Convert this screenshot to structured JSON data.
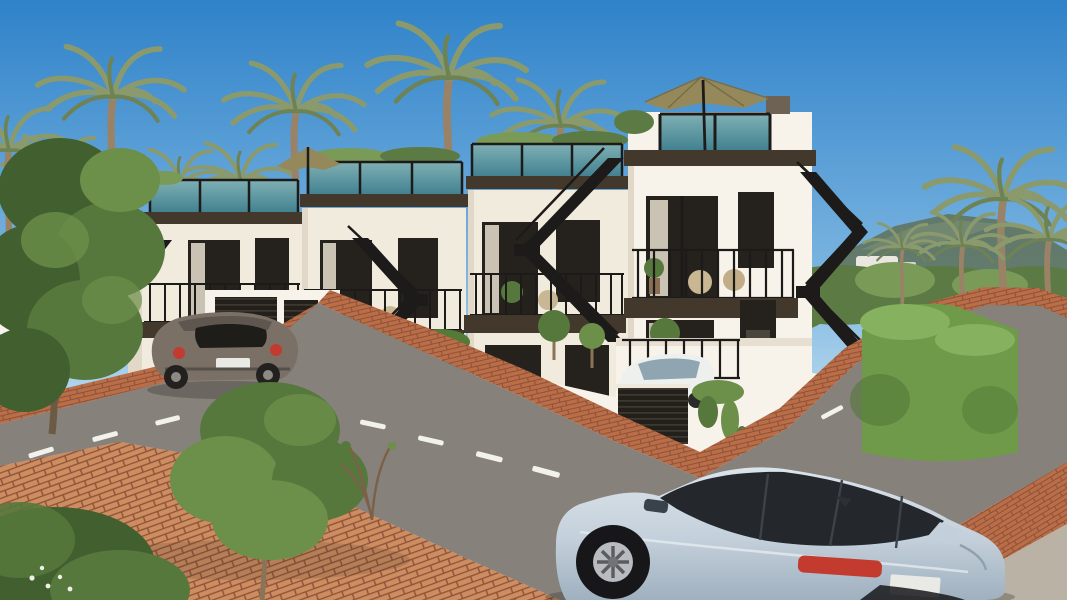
{
  "meta": {
    "title": "New-build terraced houses street view – architectural render",
    "type": "photorealistic exterior rendering",
    "width": 1067,
    "height": 600
  },
  "palette": {
    "sky_top": "#2f82c9",
    "sky_mid": "#7ab4e0",
    "sky_horizon": "#d9edf5",
    "hill": "#60745f",
    "hill_light": "#7d9077",
    "vegetation": "#5c7a43",
    "vegetation_light": "#7a9a58",
    "palm_frond": "#8a9a6c",
    "palm_frond_dark": "#6f8254",
    "palm_trunk": "#9a8266",
    "wall_sunlit": "#f1ebde",
    "wall_bright": "#f7f3ea",
    "wall_shaded": "#e2d8c7",
    "fascia": "#42382c",
    "roof_glass": "#3f7f8f",
    "roof_glass_light": "#7fb0b4",
    "metal": "#1c1b19",
    "window_dark": "#25221d",
    "curtain": "#ddd5c5",
    "slat_dark": "#23201c",
    "slat_line": "#3e382f",
    "road": "#9c968a",
    "road_light": "#aca698",
    "road_dark": "#86817a",
    "brick": "#b96e48",
    "brick_joint": "#8f5138",
    "brick_light": "#cc8d60",
    "marking": "#f2f1ec",
    "hedge": "#6f9a4a",
    "hedge_light": "#86b25f",
    "hedge_dark": "#547a38",
    "tree_dark": "#42602f",
    "tree_mid": "#57783c",
    "tree_light": "#6c8f4a",
    "umbrella": "#95895c",
    "umbrella_dark": "#776c45",
    "suv_body": "#c3cfda",
    "suv_body_dark": "#9fb0bf",
    "suv_glass": "#24272b",
    "beetle_body": "#7b7065",
    "beetle_dark": "#57504a",
    "white_car": "#eef0ee",
    "taillight": "#c33a2e",
    "plate": "#e9eae6",
    "concrete": "#b9b2a5",
    "shadow": "#2f2b25"
  },
  "scene": {
    "setting": "sunny coastal street with palm trees and hills",
    "buildings": {
      "count": 4,
      "style": "white modern townhouses stepping down a sloped street",
      "features": [
        "roof terraces with teal glass balustrades",
        "khaki parasols",
        "dark brown fascia bands",
        "black metal balconies",
        "external zig-zag staircases",
        "dark slatted garage doors",
        "terracotta brick walkways"
      ]
    },
    "vehicles": [
      {
        "type": "suv",
        "color": "light blue with black roof",
        "position": "driving in foreground"
      },
      {
        "type": "hatchback",
        "color": "grey-brown",
        "position": "parked at far kerb"
      },
      {
        "type": "crossover",
        "color": "white",
        "position": "driveway behind slatted gate"
      }
    ],
    "street": {
      "surface": "asphalt",
      "markings": "white dashed centre line",
      "sidewalk": "terracotta brick pavers"
    },
    "landscape": {
      "palms": 11,
      "hedges": "clipped green hedges along garden walls",
      "foreground": "leafy trees and shrubs lower left"
    }
  }
}
